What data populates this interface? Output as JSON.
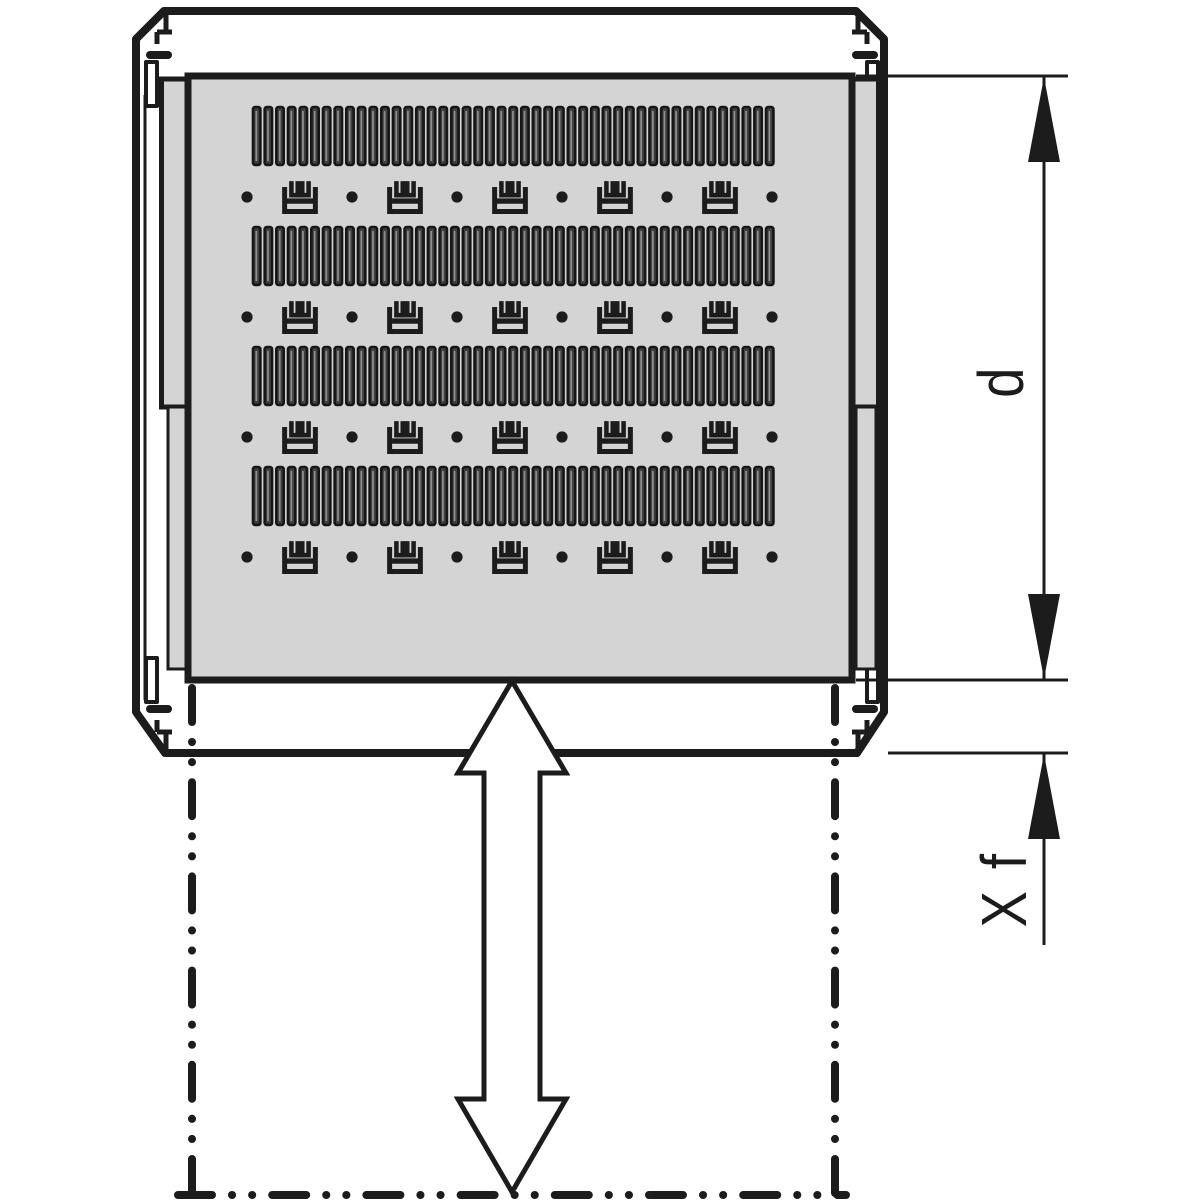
{
  "diagram": {
    "labels": {
      "depth": "d",
      "travel": "X f"
    },
    "colors": {
      "line": "#1c1c1c",
      "panel": "#d4d4d4",
      "slot_fill": "#414141",
      "slot_outline": "#161616",
      "slot_highlight": "#8f8f8f",
      "background": "#ffffff"
    },
    "shelf": {
      "vent_rows": 4,
      "slots_per_row": 45,
      "fixing_rows": 4,
      "holes_per_row": 6,
      "brackets_per_row": 5
    }
  }
}
